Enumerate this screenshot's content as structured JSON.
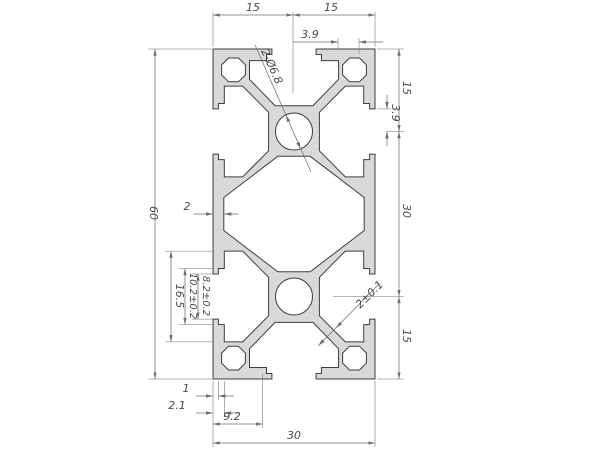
{
  "colors": {
    "bg": "#ffffff",
    "fill": "#d9d9d9",
    "stroke": "#3d3d3d",
    "dim": "#6f6f6f",
    "text": "#4a4a4a"
  },
  "dimensions": {
    "top": {
      "left_half": "15",
      "right_half": "15",
      "lip": "3.9"
    },
    "right": {
      "top": "15",
      "lip": "3.9",
      "middle": "30",
      "bottom": "15"
    },
    "left": {
      "height": "60",
      "wall": "2"
    },
    "slot": {
      "opening": "8.2±0.2",
      "step": "10.2±0.2",
      "cavity": "16.5"
    },
    "bottom": {
      "foot": "1",
      "lip": "2.1",
      "pocket": "9.2",
      "width": "30"
    },
    "leaders": {
      "core_holes": "2-Ø6.8",
      "web": "2±0.1"
    }
  }
}
